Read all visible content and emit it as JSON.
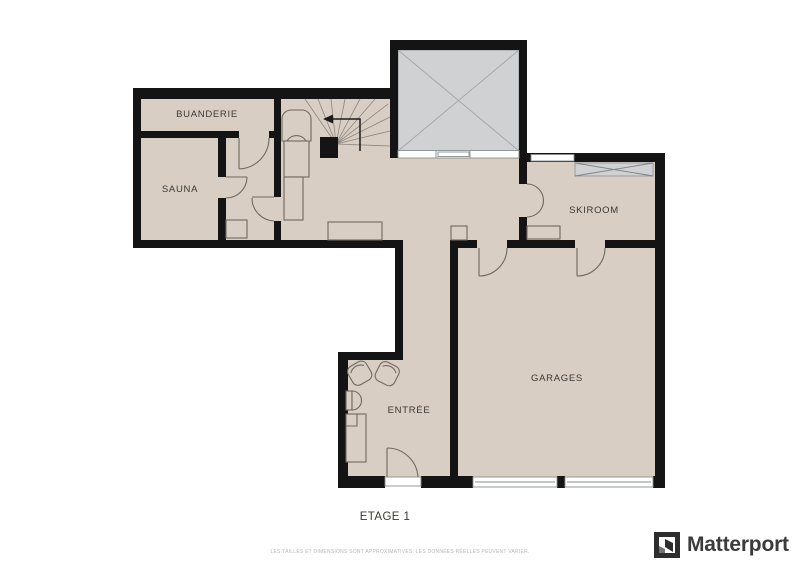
{
  "floorplan": {
    "floor_title": "ETAGE 1",
    "rooms": {
      "buanderie": "BUANDERIE",
      "sauna": "SAUNA",
      "skiroom": "SKIROOM",
      "garages": "GARAGES",
      "entree": "ENTRÉE"
    },
    "disclaimer": "LES TAILLES ET DIMENSIONS SONT APPROXIMATIVES. LES DONNÉES RÉELLES PEUVENT VARIER.",
    "colors": {
      "floor": "#d8cec4",
      "wall": "#141414",
      "void_fill": "#cfd1d3",
      "line": "#70695f",
      "label": "#3c3832",
      "disclaimer_text": "#b9b6b2",
      "logo_text": "#3b3b3b"
    }
  },
  "branding": {
    "logo_text": "Matterport"
  }
}
